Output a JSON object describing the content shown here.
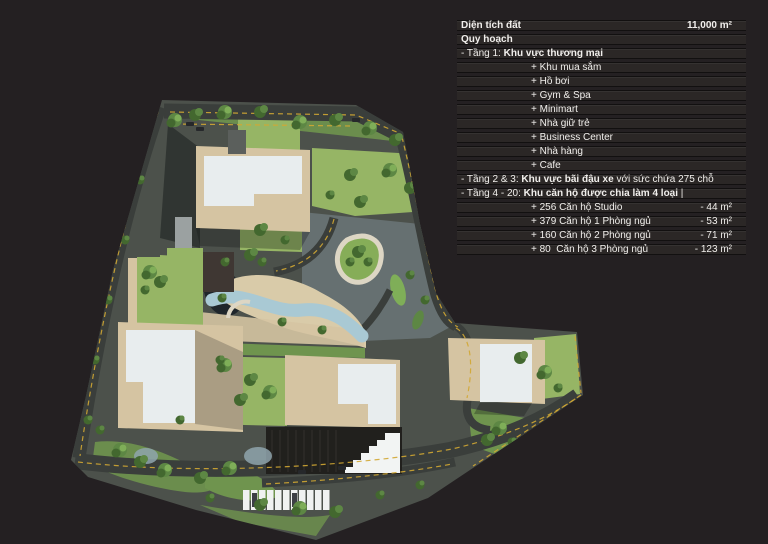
{
  "palette": {
    "bg": "#242022",
    "row_bg": "#2b2726",
    "row_border": "#121010",
    "text": "#f1efec",
    "site_base": "#4c514b",
    "road": "#3a3e3b",
    "road_line_yellow": "#d2a733",
    "lawn_light": "#96b565",
    "lawn_mid": "#6f944e",
    "tree_dark": "#43682f",
    "tree_mid": "#5d8744",
    "deck_tan": "#d5c4a2",
    "sand": "#d9cba9",
    "roof_white": "#e8edee",
    "pool_blue": "#a9c9d4",
    "bluegray": "#6b7678",
    "garage_dark": "#21201d",
    "stall_white": "#f0f2f1"
  },
  "panel": {
    "rows": [
      {
        "header": true,
        "pre": "",
        "strong": "Diện tích đất",
        "post": "",
        "right": "11,000 m²"
      },
      {
        "pre": "",
        "strong": "Quy hoạch",
        "post": "",
        "right": ""
      },
      {
        "pre": "- Tầng 1: ",
        "strong": "Khu vực thương mại",
        "post": "",
        "right": ""
      },
      {
        "indent": true,
        "pre": "+ Khu mua sắm",
        "strong": "",
        "post": "",
        "right": ""
      },
      {
        "indent": true,
        "pre": "+ Hồ bơi",
        "strong": "",
        "post": "",
        "right": ""
      },
      {
        "indent": true,
        "pre": "+ Gym & Spa",
        "strong": "",
        "post": "",
        "right": ""
      },
      {
        "indent": true,
        "pre": "+ Minimart",
        "strong": "",
        "post": "",
        "right": ""
      },
      {
        "indent": true,
        "pre": "+ Nhà giữ trẻ",
        "strong": "",
        "post": "",
        "right": ""
      },
      {
        "indent": true,
        "pre": "+ Business Center",
        "strong": "",
        "post": "",
        "right": ""
      },
      {
        "indent": true,
        "pre": "+ Nhà hàng",
        "strong": "",
        "post": "",
        "right": ""
      },
      {
        "indent": true,
        "pre": "+ Cafe",
        "strong": "",
        "post": "",
        "right": ""
      },
      {
        "pre": "- Tầng 2 & 3: ",
        "strong": "Khu vực bãi đậu xe",
        "post": " với sức chứa 275 chỗ",
        "right": ""
      },
      {
        "pre": "- Tầng 4 - 20: ",
        "strong": "Khu căn hộ được chia làm 4 loại",
        "post": " |",
        "right": ""
      },
      {
        "indent": true,
        "pre": "+ 256 Căn hộ Studio",
        "strong": "",
        "post": "",
        "right": "- 44 m²"
      },
      {
        "indent": true,
        "pre": "+ 379 Căn hộ 1 Phòng ngủ",
        "strong": "",
        "post": "",
        "right": "- 53 m²"
      },
      {
        "indent": true,
        "pre": "+ 160 Căn hộ 2 Phòng ngủ",
        "strong": "",
        "post": "",
        "right": "- 71 m²"
      },
      {
        "indent": true,
        "pre": "+ 80  Căn hộ 3 Phòng ngủ",
        "strong": "",
        "post": "",
        "right": "- 123 m²"
      }
    ]
  }
}
